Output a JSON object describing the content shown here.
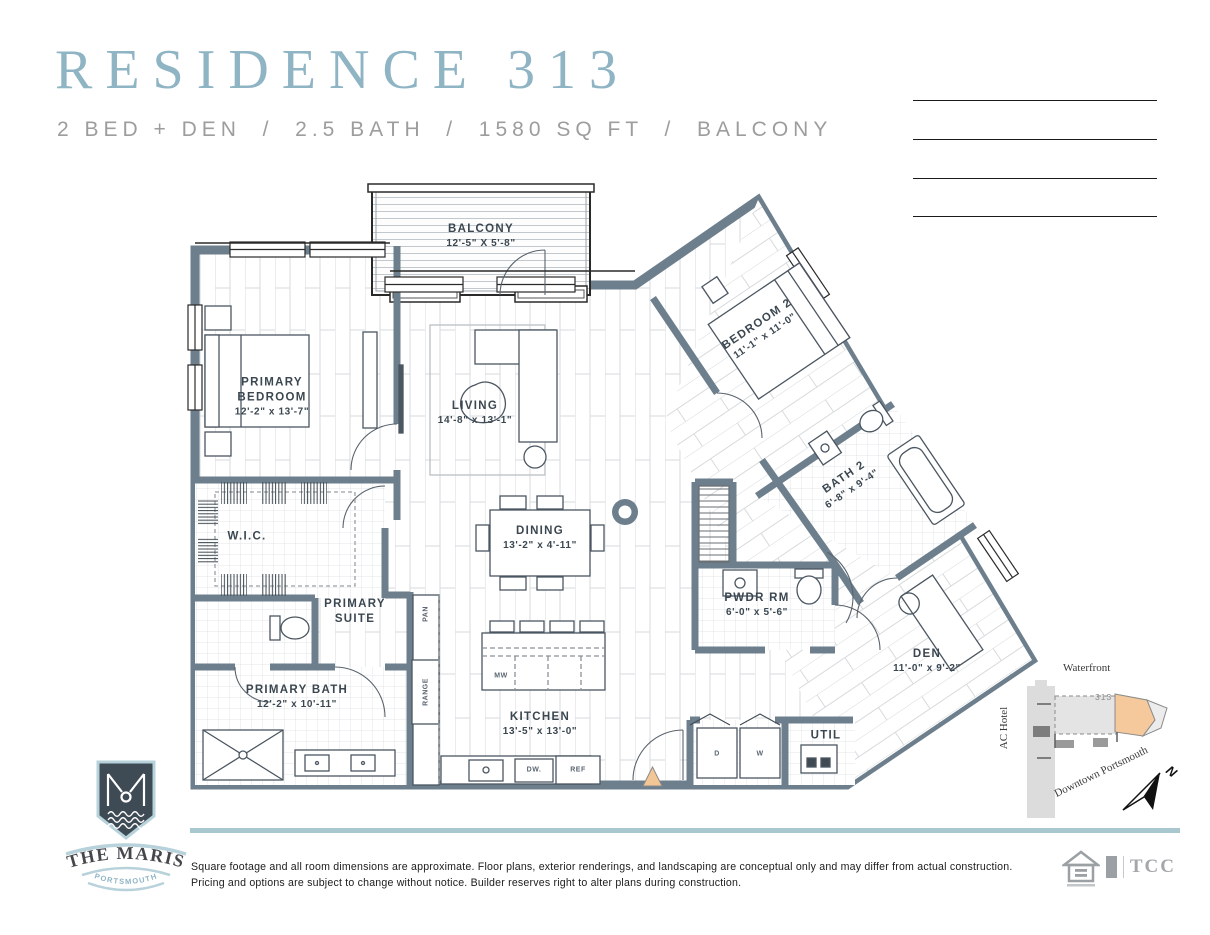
{
  "header": {
    "title": "RESIDENCE 313",
    "subtitle": "2 BED + DEN  /  2.5 BATH  /  1580 SQ FT  /  BALCONY"
  },
  "floorplan": {
    "rooms": [
      {
        "name": "BALCONY",
        "dims": "12'-5\" X 5'-8\""
      },
      {
        "name": "PRIMARY BEDROOM",
        "dims": "12'-2\" x 13'-7\""
      },
      {
        "name": "LIVING",
        "dims": "14'-8\" x 13'-1\""
      },
      {
        "name": "BEDROOM 2",
        "dims": "11'-1\" x 11'-0\""
      },
      {
        "name": "W.I.C."
      },
      {
        "name": "DINING",
        "dims": "13'-2\" x 4'-11\""
      },
      {
        "name": "BATH 2",
        "dims": "6'-8\" x 9'-4\""
      },
      {
        "name": "PRIMARY SUITE"
      },
      {
        "name": "PWDR RM",
        "dims": "6'-0\" x 5'-6\""
      },
      {
        "name": "PRIMARY BATH",
        "dims": "12'-2\" x 10'-11\""
      },
      {
        "name": "KITCHEN",
        "dims": "13'-5\" x 13'-0\""
      },
      {
        "name": "DEN",
        "dims": "11'-0\" x 9'-2\""
      },
      {
        "name": "UTIL"
      }
    ],
    "fixtures": {
      "microwave": "MW",
      "dishwasher": "DW.",
      "refrigerator": "REF",
      "dryer": "D",
      "washer": "W",
      "range": "RANGE",
      "pantry": "PAN"
    }
  },
  "site_map": {
    "waterfront_label": "Waterfront",
    "hotel_label": "AC Hotel",
    "unit_number": "313",
    "downtown_label": "Downtown Portsmouth",
    "north_label": "N"
  },
  "branding": {
    "monogram": "M",
    "name": "THE MARIS",
    "city": "PORTSMOUTH"
  },
  "footer": {
    "disclaimer_line1": "Square footage and all room dimensions are approximate. Floor plans, exterior renderings, and landscaping are conceptual only and may differ from actual construction. Pricing and options are",
    "disclaimer_line2": "subject to change without notice. Builder reserves right to alter plans during construction.",
    "partner_logo_text": "TCC"
  },
  "colors": {
    "wall": "#6d7e8c",
    "title_blue": "#8fb4c4",
    "divider_blue": "#a9c7cf",
    "entry_marker": "#f3c795",
    "map_highlight": "#f5c99c",
    "logo_navy": "#3e4a54",
    "logo_blue": "#b7d2da"
  }
}
